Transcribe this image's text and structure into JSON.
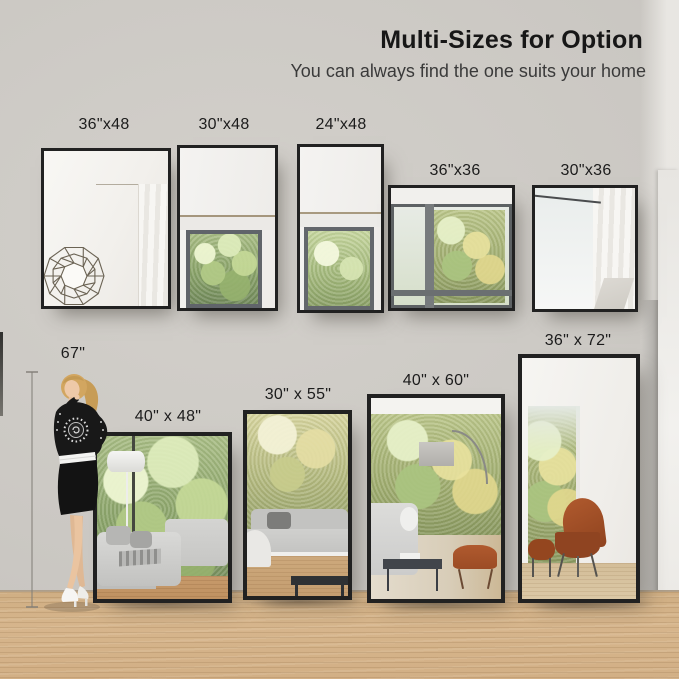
{
  "header": {
    "title": "Multi-Sizes for Option",
    "subtitle": "You can always find the one suits your home"
  },
  "model": {
    "height_label": "67\""
  },
  "wall_mirrors": [
    {
      "label": "36\"x48"
    },
    {
      "label": "30\"x48"
    },
    {
      "label": "24\"x48"
    },
    {
      "label": "36\"x36"
    },
    {
      "label": "30\"x36"
    }
  ],
  "floor_mirrors": [
    {
      "label": "40\" x 48\""
    },
    {
      "label": "30\" x 55\""
    },
    {
      "label": "40\" x 60\""
    },
    {
      "label": "36\" x 72\""
    }
  ],
  "colors": {
    "wall": "#cac7c2",
    "floor_wood": "#d3b089",
    "mirror_frame": "#212121",
    "text": "#1c1c1c"
  }
}
